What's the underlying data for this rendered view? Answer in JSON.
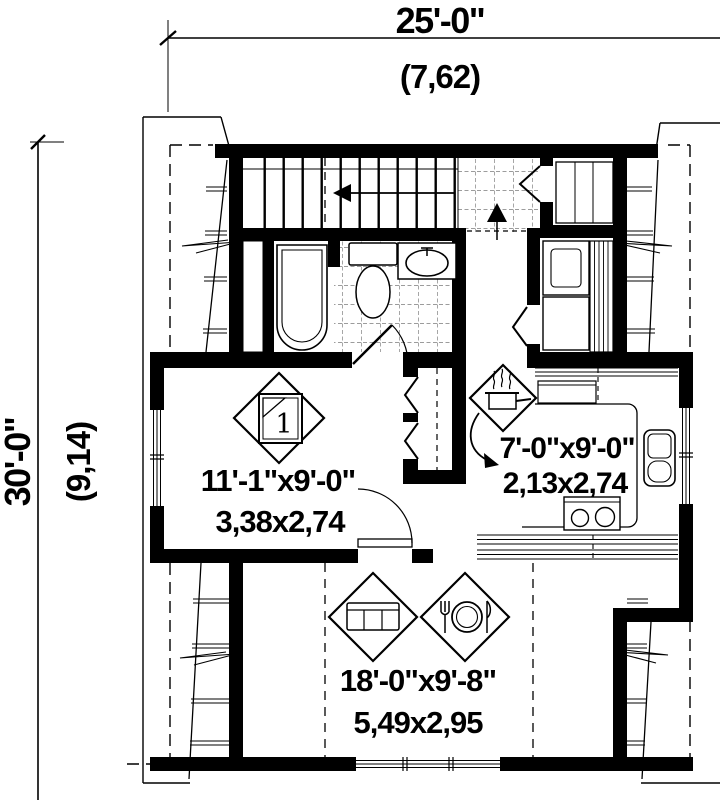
{
  "plan": {
    "type": "architectural-floor-plan-upper-level",
    "dimensions": {
      "width": {
        "imperial": "25'-0\"",
        "metric": "(7,62)"
      },
      "depth": {
        "imperial": "30'-0\"",
        "metric": "(9,14)"
      }
    },
    "rooms": {
      "bedroom": {
        "icon": "bed-number-1",
        "bed_number": "1",
        "size_imperial": "11'-1\"x9'-0\"",
        "size_metric": "3,38x2,74"
      },
      "kitchen": {
        "icon": "cooking-pot",
        "size_imperial": "7'-0\"x9'-0\"",
        "size_metric": "2,13x2,74"
      },
      "living_dining": {
        "icons": [
          "sofa",
          "dining-plate"
        ],
        "size_imperial": "18'-0\"x9'-8\"",
        "size_metric": "5,49x2,95"
      }
    },
    "features": [
      "staircase-down-arrow",
      "landing-up-arrow",
      "bathtub",
      "toilet",
      "vanity-sink",
      "bifold-closets",
      "washer-dryer",
      "kitchen-sink",
      "stove",
      "windows",
      "roof-slope-lines"
    ],
    "colors": {
      "line": "#000000",
      "background": "#ffffff",
      "tile_grid": "#3a3a3a"
    }
  }
}
